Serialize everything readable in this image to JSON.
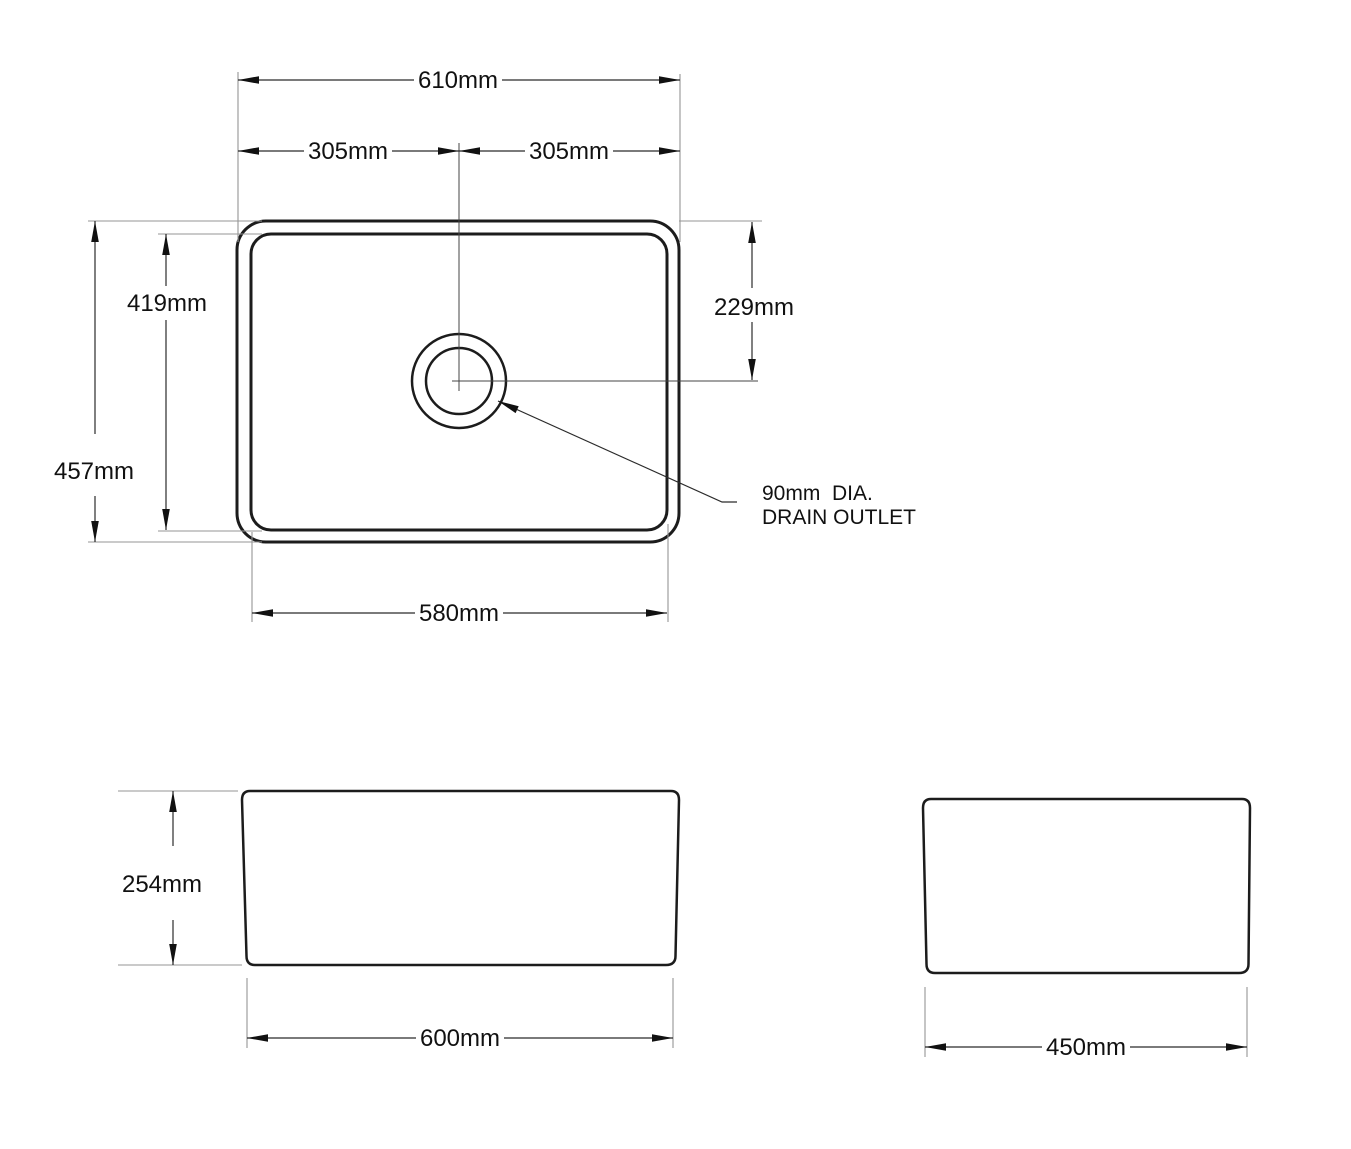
{
  "dimensions": {
    "top_view": {
      "overall_width": "610mm",
      "center_to_left": "305mm",
      "center_to_right": "305mm",
      "bowl_length": "419mm",
      "overall_length": "457mm",
      "drain_offset_from_top": "229mm",
      "bowl_width": "580mm"
    },
    "front_view": {
      "height": "254mm",
      "base_width": "600mm"
    },
    "side_view": {
      "base_width": "450mm"
    },
    "drain_note": {
      "line1": "90mm  DIA.",
      "line2": "DRAIN OUTLET"
    }
  },
  "colors": {
    "outline": "#1c1c1c",
    "dimension_line": "#2b2b2b",
    "extension_line": "#959595",
    "background": "#ffffff"
  }
}
